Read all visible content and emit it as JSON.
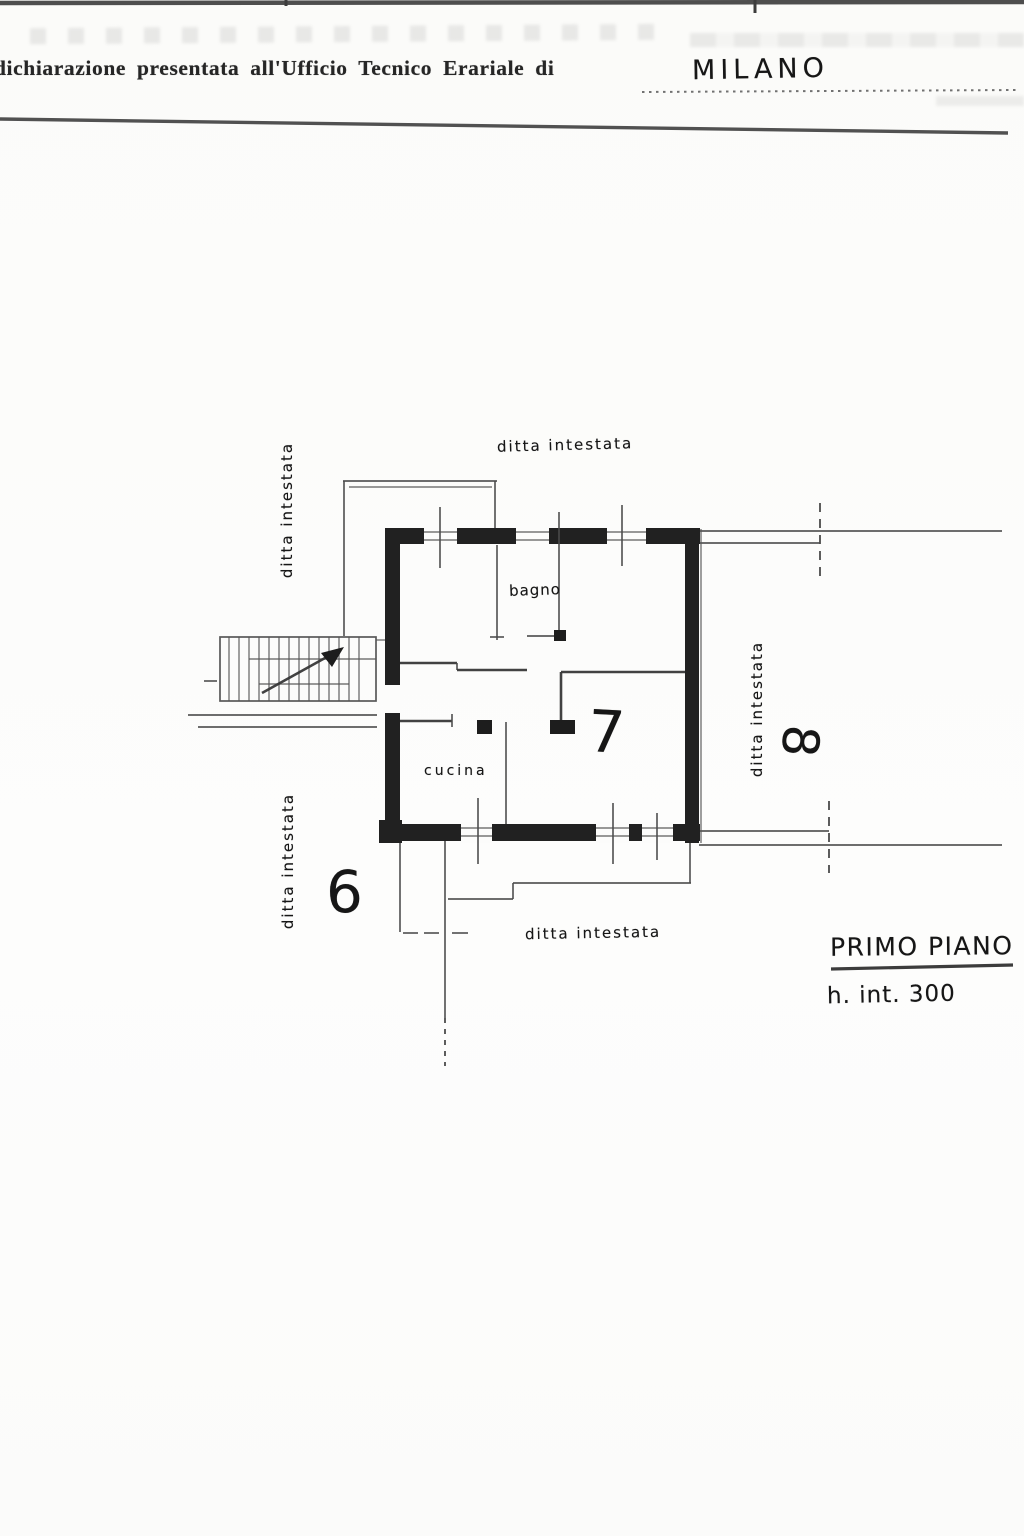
{
  "header": {
    "form_label": "dichiarazione presentata all'Ufficio Tecnico Erariale di",
    "city_value": "MILANO"
  },
  "plan": {
    "label_top": "ditta intestata",
    "label_left_upper": "ditta intestata",
    "label_left_lower": "ditta intestata",
    "label_right": "ditta intestata",
    "label_bottom": "ditta intestata",
    "room_bath": "bagno",
    "room_kitchen": "cucina",
    "unit_current": "7",
    "unit_left": "6",
    "unit_right": "8",
    "floor_title": "PRIMO PIANO",
    "height_note": "h. int. 300"
  },
  "colors": {
    "wall": "#212121",
    "thin_line": "#4b4b4b",
    "paper": "#fbfbf9"
  }
}
